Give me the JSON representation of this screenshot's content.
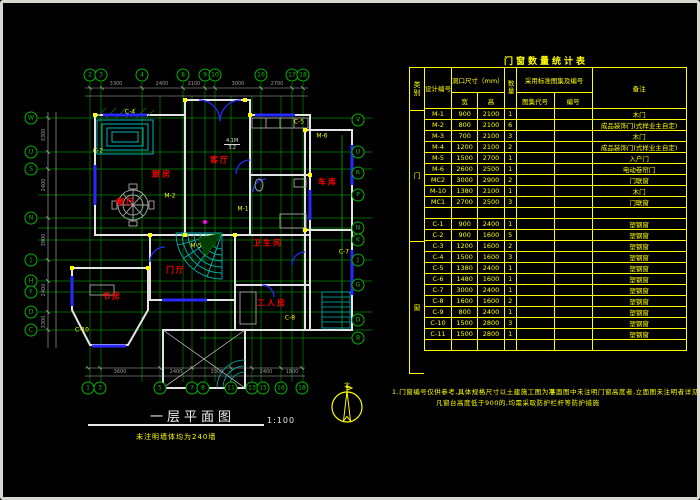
{
  "plan": {
    "title": "一层平面图",
    "scale": "1:100",
    "note": "未注明墙体均为240墙",
    "north_label": "北",
    "room_tag_upper": "4.1M",
    "room_tag_lower": "3.2",
    "grid_top": [
      {
        "x": 90,
        "label": "2"
      },
      {
        "x": 101,
        "label": "3"
      },
      {
        "x": 142,
        "label": "4"
      },
      {
        "x": 183,
        "label": "8"
      },
      {
        "x": 205,
        "label": "9"
      },
      {
        "x": 215,
        "label": "10"
      },
      {
        "x": 261,
        "label": "16"
      },
      {
        "x": 292,
        "label": "17"
      },
      {
        "x": 303,
        "label": "18"
      }
    ],
    "grid_bottom": [
      {
        "x": 88,
        "label": "1"
      },
      {
        "x": 100,
        "label": "3"
      },
      {
        "x": 160,
        "label": "5"
      },
      {
        "x": 192,
        "label": "7"
      },
      {
        "x": 203,
        "label": "8"
      },
      {
        "x": 231,
        "label": "11"
      },
      {
        "x": 252,
        "label": "13"
      },
      {
        "x": 263,
        "label": "15"
      },
      {
        "x": 281,
        "label": "16"
      },
      {
        "x": 302,
        "label": "18"
      }
    ],
    "grid_left": [
      {
        "y": 118,
        "label": "W"
      },
      {
        "y": 152,
        "label": "U"
      },
      {
        "y": 169,
        "label": "S"
      },
      {
        "y": 218,
        "label": "N"
      },
      {
        "y": 260,
        "label": "J"
      },
      {
        "y": 281,
        "label": "H"
      },
      {
        "y": 292,
        "label": "F"
      },
      {
        "y": 312,
        "label": "D"
      },
      {
        "y": 330,
        "label": "C"
      }
    ],
    "grid_right": [
      {
        "y": 120,
        "label": "V"
      },
      {
        "y": 152,
        "label": "U"
      },
      {
        "y": 173,
        "label": "R"
      },
      {
        "y": 195,
        "label": "P"
      },
      {
        "y": 228,
        "label": "N"
      },
      {
        "y": 240,
        "label": "K"
      },
      {
        "y": 260,
        "label": "J"
      },
      {
        "y": 285,
        "label": "G"
      },
      {
        "y": 320,
        "label": "D"
      },
      {
        "y": 338,
        "label": "B"
      }
    ],
    "rooms": [
      {
        "x": 220,
        "y": 160,
        "label": "客厅"
      },
      {
        "x": 126,
        "y": 202,
        "label": "餐厅"
      },
      {
        "x": 162,
        "y": 174,
        "label": "厨房"
      },
      {
        "x": 176,
        "y": 270,
        "label": "门厅"
      },
      {
        "x": 112,
        "y": 296,
        "label": "书房"
      },
      {
        "x": 268,
        "y": 243,
        "label": "卫生间"
      },
      {
        "x": 272,
        "y": 303,
        "label": "工人房"
      },
      {
        "x": 328,
        "y": 182,
        "label": "车库"
      }
    ],
    "tags": [
      {
        "x": 98,
        "y": 151,
        "label": "C-2"
      },
      {
        "x": 170,
        "y": 196,
        "label": "M-2"
      },
      {
        "x": 243,
        "y": 209,
        "label": "M-1"
      },
      {
        "x": 130,
        "y": 112,
        "label": "C-4"
      },
      {
        "x": 299,
        "y": 122,
        "label": "C-5"
      },
      {
        "x": 196,
        "y": 246,
        "label": "M-5"
      },
      {
        "x": 82,
        "y": 330,
        "label": "C-10"
      },
      {
        "x": 322,
        "y": 136,
        "label": "M-6"
      },
      {
        "x": 344,
        "y": 252,
        "label": "C-7"
      },
      {
        "x": 290,
        "y": 318,
        "label": "C-8"
      }
    ],
    "dims_top": [
      {
        "x": 116,
        "label": "3300"
      },
      {
        "x": 162,
        "label": "2400"
      },
      {
        "x": 194,
        "label": "2100"
      },
      {
        "x": 238,
        "label": "3000"
      },
      {
        "x": 277,
        "label": "2700"
      }
    ],
    "dims_bottom": [
      {
        "x": 120,
        "label": "3600"
      },
      {
        "x": 176,
        "label": "2400"
      },
      {
        "x": 217,
        "label": "3300"
      },
      {
        "x": 266,
        "label": "2400"
      },
      {
        "x": 292,
        "label": "1800"
      }
    ],
    "dims_left": [
      {
        "y": 135,
        "label": "3300"
      },
      {
        "y": 185,
        "label": "2400"
      },
      {
        "y": 240,
        "label": "3900"
      },
      {
        "y": 290,
        "label": "2400"
      },
      {
        "y": 322,
        "label": "3300"
      }
    ]
  },
  "schedule": {
    "title": "门窗数量统计表",
    "headers": {
      "category": "类别",
      "design_no": "设计编号",
      "opening": "洞口尺寸（mm）",
      "width": "宽",
      "height": "高",
      "qty": "数量",
      "atlas": "采用标准图集及编号",
      "atlas_code": "图集代号",
      "atlas_no": "编号",
      "remark": "备注"
    },
    "sections": {
      "door": "门",
      "window": "窗"
    },
    "rows": [
      {
        "id": "M-1",
        "w": "900",
        "h": "2100",
        "qty": "1",
        "atlas_code": "",
        "atlas_no": "",
        "remark": "木门"
      },
      {
        "id": "M-2",
        "w": "800",
        "h": "2100",
        "qty": "6",
        "atlas_code": "",
        "atlas_no": "",
        "remark": "成品装饰门(式样业主自定)"
      },
      {
        "id": "M-3",
        "w": "700",
        "h": "2100",
        "qty": "3",
        "atlas_code": "",
        "atlas_no": "",
        "remark": "木门"
      },
      {
        "id": "M-4",
        "w": "1200",
        "h": "2100",
        "qty": "2",
        "atlas_code": "",
        "atlas_no": "",
        "remark": "成品装饰门(式样业主自定)"
      },
      {
        "id": "M-5",
        "w": "1500",
        "h": "2700",
        "qty": "1",
        "atlas_code": "",
        "atlas_no": "",
        "remark": "入户门"
      },
      {
        "id": "M-6",
        "w": "2600",
        "h": "2500",
        "qty": "1",
        "atlas_code": "",
        "atlas_no": "",
        "remark": "电动卷帘门"
      },
      {
        "id": "MC2",
        "w": "3000",
        "h": "2900",
        "qty": "2",
        "atlas_code": "",
        "atlas_no": "",
        "remark": "门联窗"
      },
      {
        "id": "M-10",
        "w": "1380",
        "h": "2100",
        "qty": "1",
        "atlas_code": "",
        "atlas_no": "",
        "remark": "木门"
      },
      {
        "id": "MC1",
        "w": "2700",
        "h": "2500",
        "qty": "3",
        "atlas_code": "",
        "atlas_no": "",
        "remark": "门联窗"
      },
      {
        "id": "",
        "w": "",
        "h": "",
        "qty": "",
        "atlas_code": "",
        "atlas_no": "",
        "remark": ""
      },
      {
        "id": "C-1",
        "w": "900",
        "h": "2400",
        "qty": "1",
        "atlas_code": "",
        "atlas_no": "",
        "remark": "塑钢窗"
      },
      {
        "id": "C-2",
        "w": "900",
        "h": "1600",
        "qty": "5",
        "atlas_code": "",
        "atlas_no": "",
        "remark": "塑钢窗"
      },
      {
        "id": "C-3",
        "w": "1200",
        "h": "1600",
        "qty": "2",
        "atlas_code": "",
        "atlas_no": "",
        "remark": "塑钢窗"
      },
      {
        "id": "C-4",
        "w": "1500",
        "h": "1600",
        "qty": "3",
        "atlas_code": "",
        "atlas_no": "",
        "remark": "塑钢窗"
      },
      {
        "id": "C-5",
        "w": "1380",
        "h": "2400",
        "qty": "1",
        "atlas_code": "",
        "atlas_no": "",
        "remark": "塑钢窗"
      },
      {
        "id": "C-6",
        "w": "1480",
        "h": "1600",
        "qty": "1",
        "atlas_code": "",
        "atlas_no": "",
        "remark": "塑钢窗"
      },
      {
        "id": "C-7",
        "w": "3000",
        "h": "2400",
        "qty": "1",
        "atlas_code": "",
        "atlas_no": "",
        "remark": "塑钢窗"
      },
      {
        "id": "C-8",
        "w": "1600",
        "h": "1600",
        "qty": "2",
        "atlas_code": "",
        "atlas_no": "",
        "remark": "塑钢窗"
      },
      {
        "id": "C-9",
        "w": "800",
        "h": "2400",
        "qty": "1",
        "atlas_code": "",
        "atlas_no": "",
        "remark": "塑钢窗"
      },
      {
        "id": "C-10",
        "w": "1500",
        "h": "2800",
        "qty": "3",
        "atlas_code": "",
        "atlas_no": "",
        "remark": "塑钢窗"
      },
      {
        "id": "C-11",
        "w": "1500",
        "h": "2800",
        "qty": "1",
        "atlas_code": "",
        "atlas_no": "",
        "remark": "塑钢窗"
      },
      {
        "id": "",
        "w": "",
        "h": "",
        "qty": "",
        "atlas_code": "",
        "atlas_no": "",
        "remark": ""
      }
    ],
    "notes": {
      "line1a": "1.门窗编号仅供参考,具体规格尺寸以土建施工图为准,",
      "line1b": "平面图中未注明门窗高度者,立面图未注明者详见门窗表",
      "line2": "凡窗台高度低于900的,均需采取防护栏杆等防护措施"
    }
  }
}
